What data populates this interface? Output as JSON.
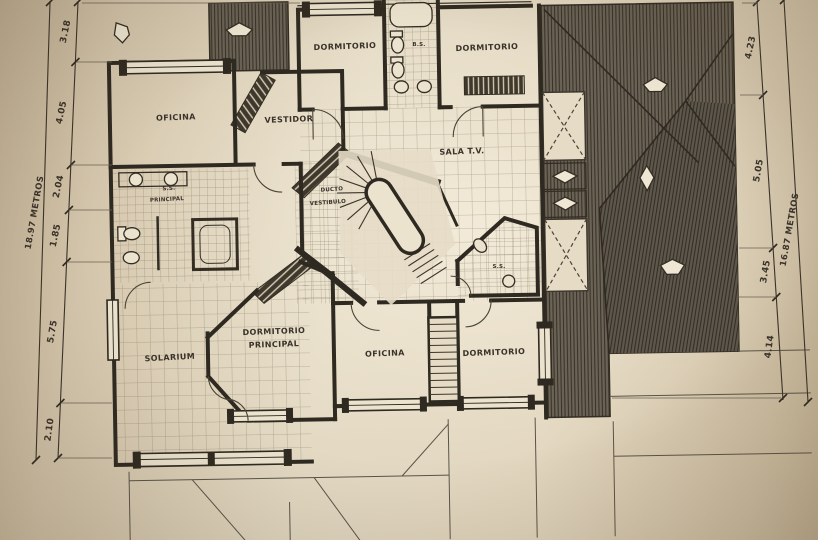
{
  "photo": {
    "description_labels_only": "second floor architectural plan",
    "colors": {
      "paper": "#ddd0b8",
      "paper_light": "#e8dfca",
      "ink": "#332d23",
      "roof_hatch": "#6b6355",
      "roof_hatch_dark": "#5e574b",
      "grid_line": "#95896f"
    },
    "icons": {
      "roof_vent_arrow": "white pentagon arrow on hatched roof",
      "skylight": "white square with dashed X"
    }
  },
  "labels": {
    "oficina_top": "OFICINA",
    "vestidor": "VESTIDOR",
    "dormitorio_top_left": "DORMITORIO",
    "banio_superior": "B.S.",
    "dormitorio_top_right": "DORMITORIO",
    "sala_tv": "SALA T.V.",
    "ducto_line1": "DUCTO",
    "ducto_line2": "VESTIBULO",
    "ss_principal_line1": "S.S.",
    "ss_principal_line2": "PRINCIPAL",
    "ss_banio": "S.S.",
    "dormitorio_principal_line1": "DORMITORIO",
    "dormitorio_principal_line2": "PRINCIPAL",
    "solarium": "SOLARIUM",
    "oficina_bottom": "OFICINA",
    "dormitorio_bottom": "DORMITORIO"
  },
  "dimensions": {
    "left": {
      "total": "18.97 METROS",
      "segments": [
        "3.18",
        "4.05",
        "2.04",
        "1.85",
        "5.75",
        "2.10"
      ]
    },
    "right": {
      "total": "16.87 METROS",
      "segments": [
        "4.23",
        "5.05",
        "3.45",
        "4.14"
      ]
    }
  }
}
